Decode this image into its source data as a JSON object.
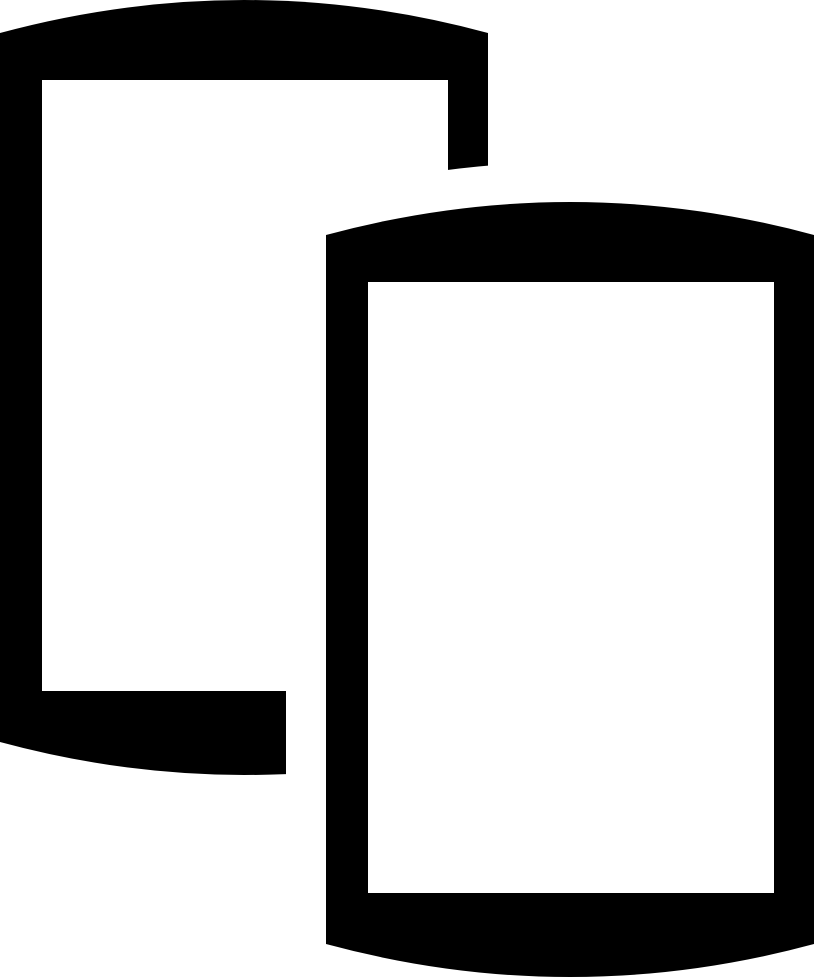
{
  "page": {
    "background_color": "#ffffff"
  },
  "icon": {
    "name": "stacked-mobile-phones",
    "description": "Glyph of two overlapping smartphones; the front phone is offset toward the lower right and knocks out the back phone with a white outline",
    "colors": {
      "glyph": "#000000",
      "screen": "#ffffff",
      "halo": "#ffffff"
    }
  }
}
